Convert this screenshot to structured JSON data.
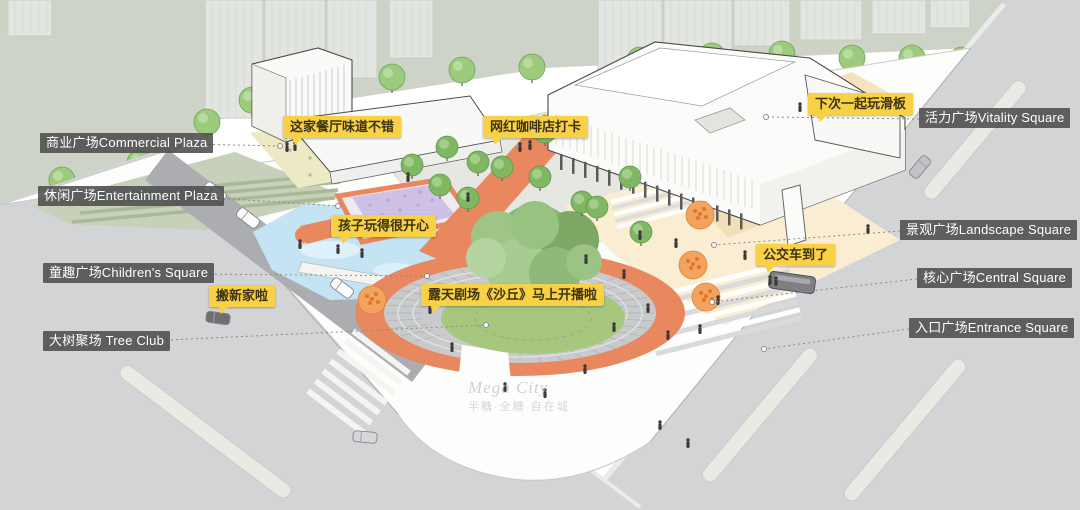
{
  "plaza_labels": [
    {
      "id": "commercial",
      "text": "商业广场Commercial Plaza",
      "side": "left"
    },
    {
      "id": "entertainment",
      "text": "休闲广场Entertainment Plaza",
      "side": "left"
    },
    {
      "id": "children",
      "text": "童趣广场Children's Square",
      "side": "left"
    },
    {
      "id": "tree_club",
      "text": "大树聚场 Tree Club",
      "side": "left"
    },
    {
      "id": "vitality",
      "text": "活力广场Vitality Square",
      "side": "right"
    },
    {
      "id": "landscape",
      "text": "景观广场Landscape Square",
      "side": "right"
    },
    {
      "id": "central",
      "text": "核心广场Central Square",
      "side": "right"
    },
    {
      "id": "entrance",
      "text": "入口广场Entrance Square",
      "side": "right"
    }
  ],
  "speech_bubbles": [
    {
      "id": "restaurant",
      "text": "这家餐厅味道不错"
    },
    {
      "id": "coffee",
      "text": "网红咖啡店打卡"
    },
    {
      "id": "skateboard",
      "text": "下次一起玩滑板"
    },
    {
      "id": "kids",
      "text": "孩子玩得很开心"
    },
    {
      "id": "theater",
      "text": "露天剧场《沙丘》马上开播啦"
    },
    {
      "id": "moving",
      "text": "搬新家啦"
    },
    {
      "id": "bus",
      "text": "公交车到了"
    }
  ],
  "watermark": {
    "line1": "Mega City",
    "line2": "半糖·全糖 自在城"
  },
  "colors": {
    "bubble": "#F8D147",
    "label_bg": "rgba(77,77,77,0.88)",
    "label_text": "#ffffff",
    "coral": "#E9875F",
    "lawn_green": "#A7C77E",
    "water_blue": "#C4E4F4",
    "sage": "#C7D0B8",
    "road_gray": "#D3D4D6",
    "background_band": "#CDD3C7",
    "beige": "#F5E3BD",
    "purple": "#CFC0E6",
    "tree_green": "#9CCB7E",
    "tree_orange": "#F2A45F"
  }
}
